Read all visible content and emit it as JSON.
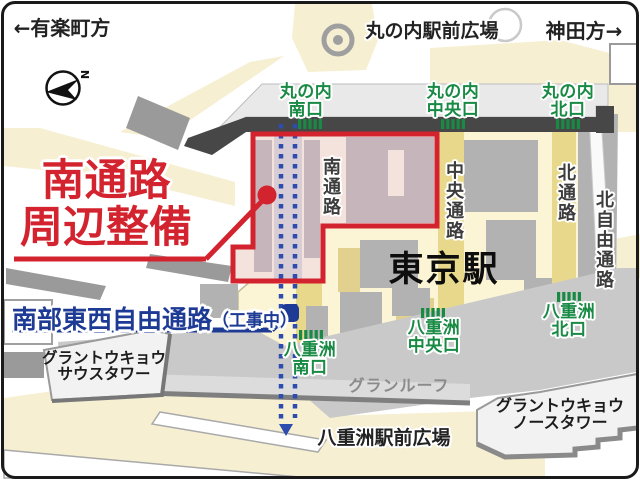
{
  "directions": {
    "yurakucho": "←有楽町方",
    "kanda": "神田方→"
  },
  "plazas": {
    "marunouchi": "丸の内駅前広場",
    "yaesu": "八重洲駅前広場"
  },
  "station": {
    "name": "東京駅"
  },
  "gates": {
    "m_south": {
      "line1": "丸の内",
      "line2": "南口"
    },
    "m_center": {
      "line1": "丸の内",
      "line2": "中央口"
    },
    "m_north": {
      "line1": "丸の内",
      "line2": "北口"
    },
    "y_center": {
      "line1": "八重洲",
      "line2": "中央口"
    },
    "y_north": {
      "line1": "八重洲",
      "line2": "北口"
    },
    "y_south": {
      "line1": "八重洲",
      "line2": "南口"
    }
  },
  "corridors": {
    "south": "南通路",
    "central": "中央通路",
    "north": "北通路",
    "north_free": "北自由通路"
  },
  "highlight": {
    "line1": "南通路",
    "line2": "周辺整備"
  },
  "construction": {
    "name": "南部東西自由通路",
    "status": "（工事中）"
  },
  "buildings": {
    "granroof": "グランルーフ",
    "south_tower_line1": "グラントウキョウ",
    "south_tower_line2": "サウスタワー",
    "north_tower_line1": "グラントウキョウ",
    "north_tower_line2": "ノースタワー"
  },
  "compass": {
    "north": "N"
  },
  "colors": {
    "highlight_red": "#d2232e",
    "construction_blue": "#1d3a94",
    "dotted_blue": "#2c4cae",
    "gate_green": "#188a44",
    "road_cream": "#f6efd2",
    "station_yellow": "#fcf5d5",
    "corridor_yellow": "#e8d88b",
    "building_gray": "#b2b2b2",
    "highlight_pink": "#f3e3dc"
  }
}
